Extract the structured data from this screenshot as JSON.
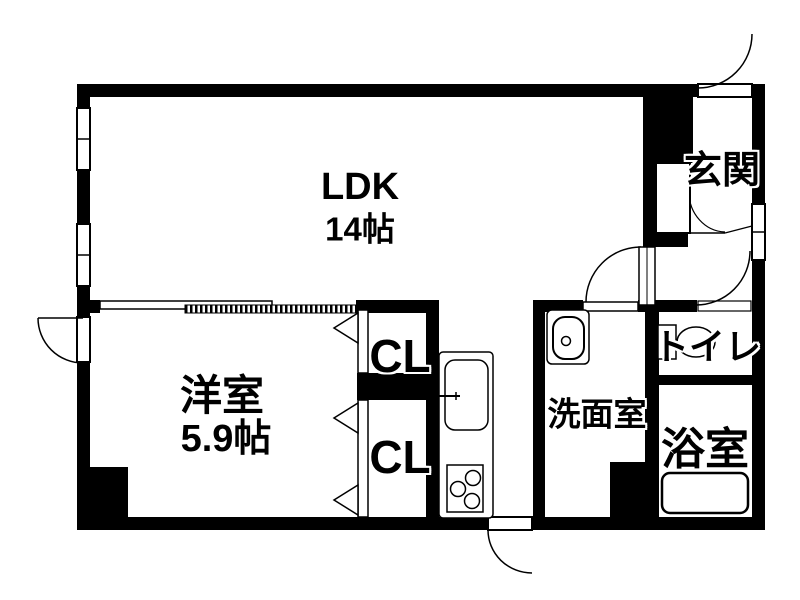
{
  "floorplan": {
    "background_color": "#ffffff",
    "wall_color": "#000000",
    "rooms": [
      {
        "id": "ldk",
        "label": "LDK",
        "size": "14帖"
      },
      {
        "id": "western_room",
        "label": "洋室",
        "size": "5.9帖"
      },
      {
        "id": "closet_upper",
        "label": "CL"
      },
      {
        "id": "closet_lower",
        "label": "CL"
      },
      {
        "id": "entrance",
        "label": "玄関"
      },
      {
        "id": "toilet",
        "label": "トイレ"
      },
      {
        "id": "washroom",
        "label": "洗面室"
      },
      {
        "id": "bathroom",
        "label": "浴室"
      }
    ],
    "fixtures": [
      "shoe-cabinet",
      "kitchen-counter",
      "kitchen-sink",
      "gas-stove",
      "wash-basin",
      "toilet-bowl",
      "bathtub"
    ],
    "openings": [
      "entrance-door",
      "left-balcony-door",
      "bottom-service-door",
      "ldk-hall-door",
      "toilet-door",
      "washroom-opening",
      "ldk-western-sliding-door",
      "closet-folding-doors",
      "window-left-upper",
      "window-left-lower",
      "window-right-hall"
    ]
  }
}
